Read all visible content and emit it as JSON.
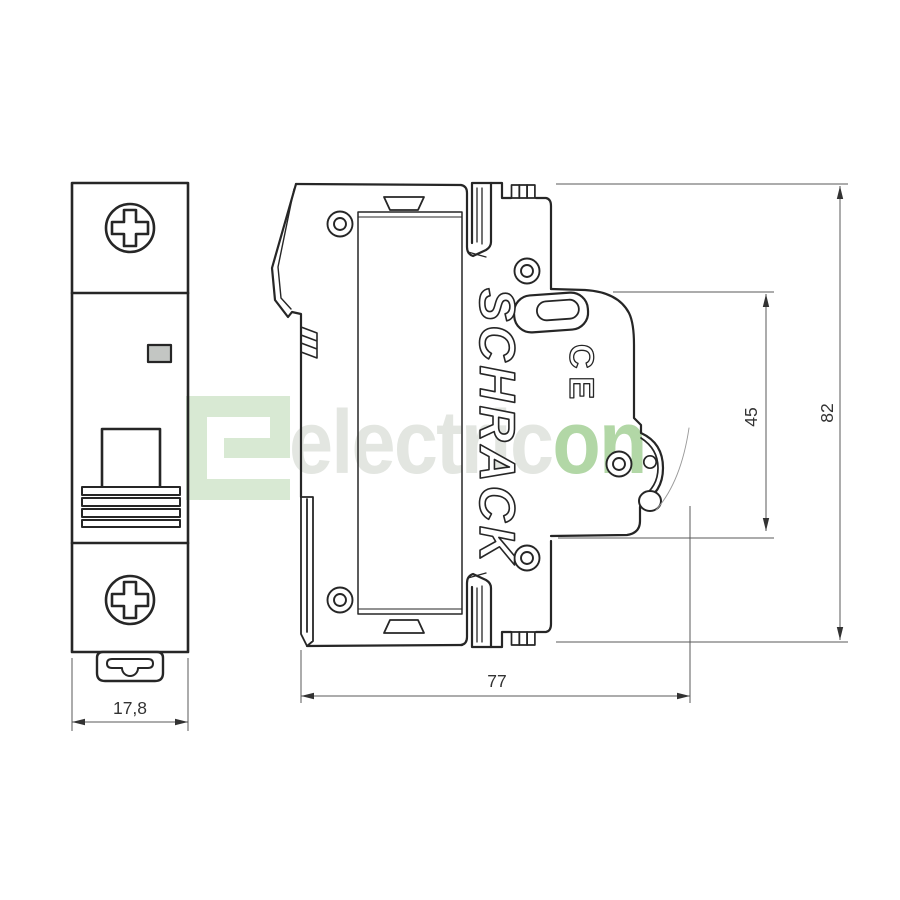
{
  "page": {
    "type": "technical-drawing",
    "subject": "miniature circuit breaker, 1-pole, front and side view"
  },
  "watermark": {
    "logo_icon": "electricon-logo",
    "text_light": "electric",
    "text_green": "on",
    "color_light": "#e3e6e1",
    "color_green": "#b2d7a6",
    "logo_color": "#d8e9d3"
  },
  "views": {
    "front": {
      "label": "front-view",
      "dimension_width": "17,8"
    },
    "side": {
      "label": "side-view",
      "brand": "SCHRACK",
      "ce_mark": "CE",
      "dimension_depth": "77",
      "dimension_front_offset": "45",
      "dimension_height": "82"
    }
  },
  "colors": {
    "line": "#262626",
    "dim_line": "#5a5a5a",
    "dim_text": "#333333",
    "indicator_fill": "#c3c6c3"
  }
}
